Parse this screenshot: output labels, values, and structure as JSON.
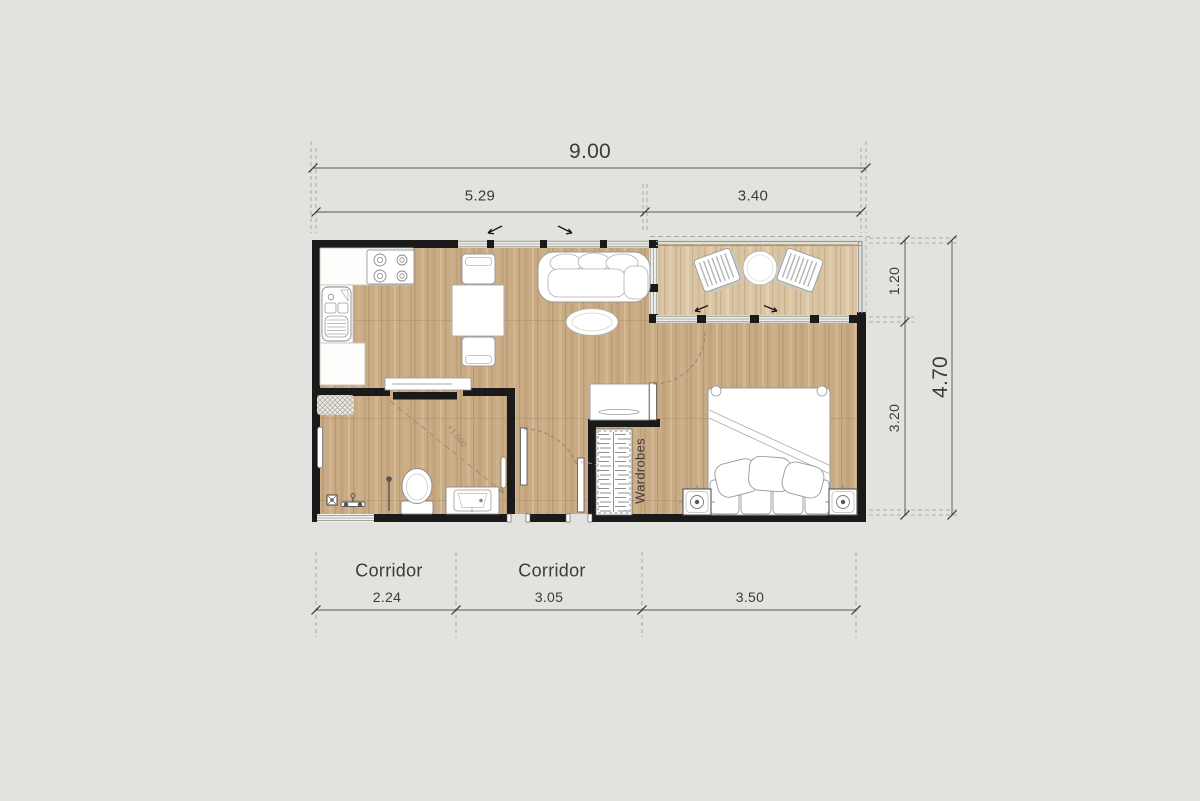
{
  "colors": {
    "background": "#e2e3de",
    "wall": "#1a1a1a",
    "floor_wood": "#c8aa85",
    "floor_balcony": "#d9c4a3",
    "dimension_text": "#3b3b3b"
  },
  "dimensions": {
    "total_width": "9.00",
    "width_living": "5.29",
    "width_balcony": "3.40",
    "total_depth": "4.70",
    "depth_balcony": "1.20",
    "depth_bedroom": "3.20",
    "corridor_1_width": "2.24",
    "corridor_2_width": "3.05",
    "bedroom_width": "3.50"
  },
  "labels": {
    "corridor_1": "Corridor",
    "corridor_2": "Corridor",
    "wardrobes": "Wardrobes",
    "floor_level": "+1.500"
  },
  "icons": [
    "stove-icon",
    "kitchen-sink-icon",
    "kitchen-counter-icon",
    "dining-table-icon",
    "dining-chair-icon",
    "sofa-icon",
    "coffee-table-icon",
    "tv-console-icon",
    "sliding-door-icon",
    "lounge-chair-icon",
    "patio-table-icon",
    "bed-icon",
    "pillow-icon",
    "nightstand-icon",
    "lamp-icon",
    "desk-icon",
    "wardrobe-icon",
    "toilet-icon",
    "bathroom-vanity-icon",
    "shower-icon",
    "floor-drain-icon",
    "doormat-icon",
    "towel-rail-icon",
    "door-swing-icon",
    "window-icon",
    "balcony-railing-icon"
  ]
}
